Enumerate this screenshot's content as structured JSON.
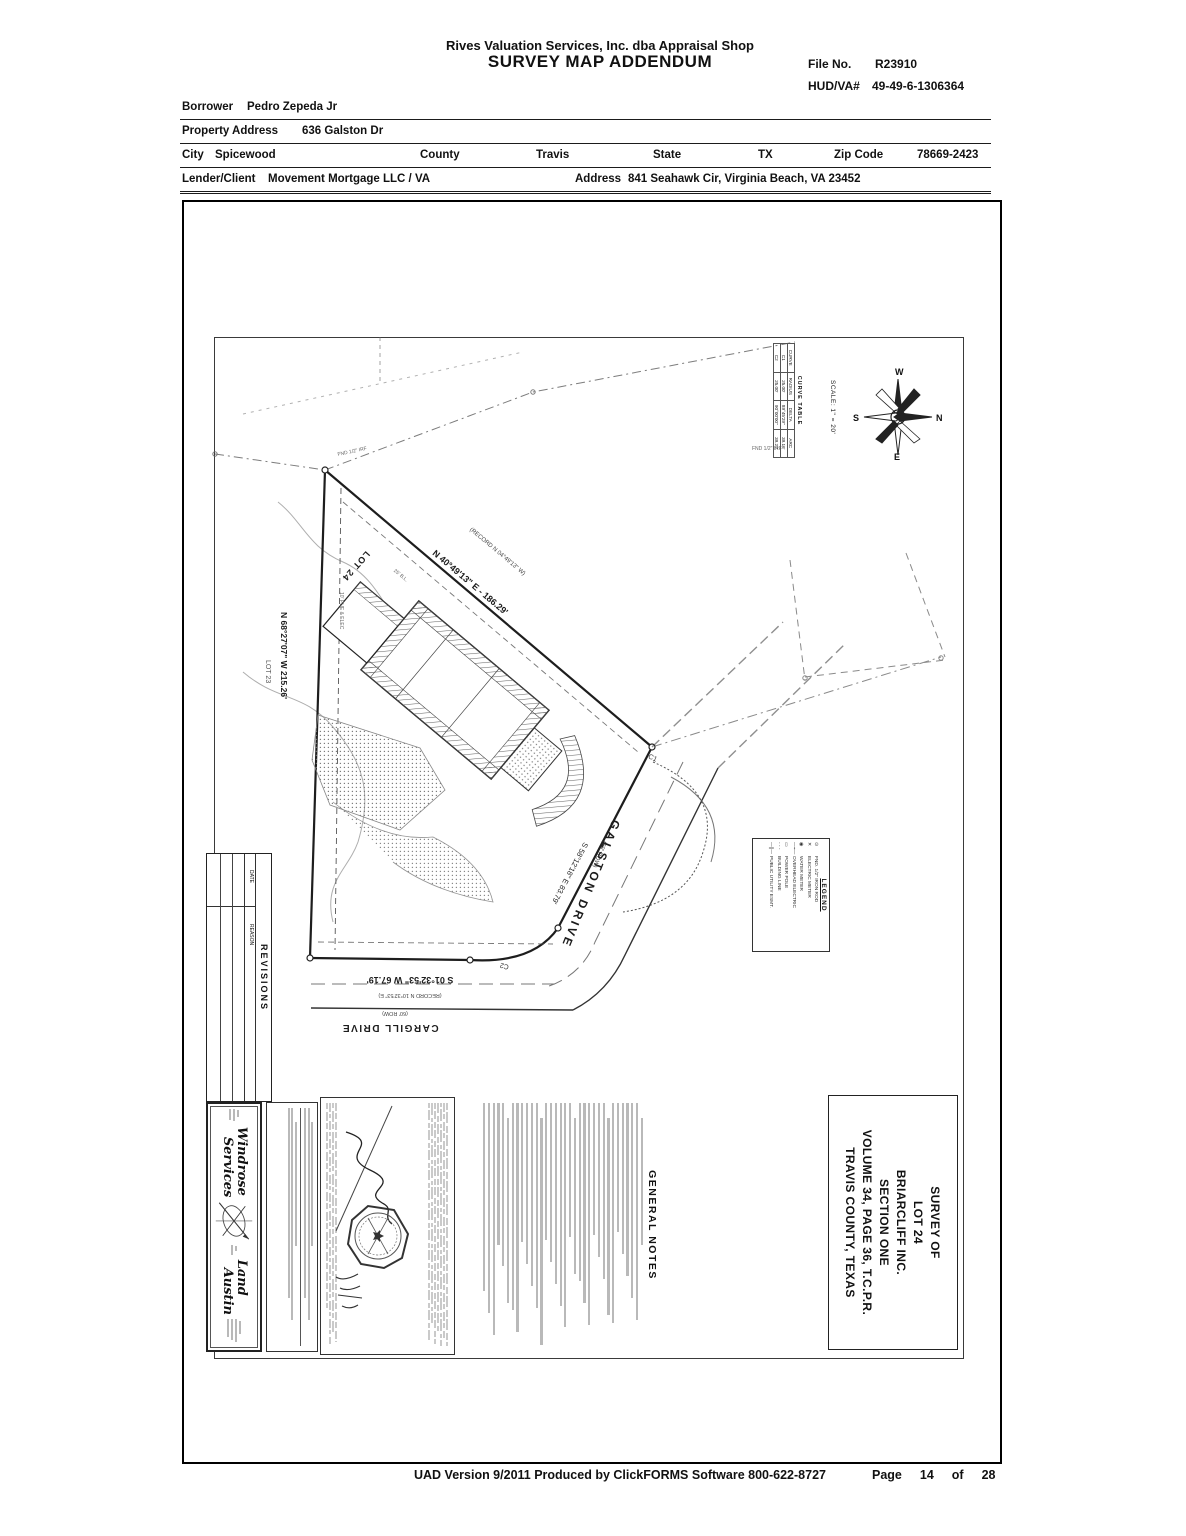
{
  "header": {
    "company": "Rives Valuation Services, Inc. dba Appraisal Shop",
    "title": "SURVEY MAP ADDENDUM",
    "file_no_label": "File No.",
    "file_no": "R23910",
    "hud_label": "HUD/VA#",
    "hud": "49-49-6-1306364"
  },
  "form": {
    "borrower_label": "Borrower",
    "borrower": "Pedro Zepeda Jr",
    "property_label": "Property Address",
    "property": "636 Galston Dr",
    "city_label": "City",
    "city": "Spicewood",
    "county_label": "County",
    "county": "Travis",
    "state_label": "State",
    "state": "TX",
    "zip_label": "Zip Code",
    "zip": "78669-2423",
    "lender_label": "Lender/Client",
    "lender": "Movement Mortgage LLC / VA",
    "address_label": "Address",
    "address": "841 Seahawk Cir, Virginia Beach, VA 23452"
  },
  "map": {
    "title_block": {
      "lines": [
        "SURVEY OF",
        "LOT 24",
        "BRIARCLIFF INC.",
        "SECTION ONE",
        "VOLUME 34, PAGE 36, T.C.P.R.",
        "TRAVIS COUNTY, TEXAS"
      ]
    },
    "notes_title": "GENERAL NOTES",
    "revisions": {
      "title": "REVISIONS",
      "date": "DATE",
      "reason": "REASON"
    },
    "compass": {
      "n": "N",
      "s": "S",
      "e": "E",
      "w": "W"
    },
    "scale": "SCALE: 1\" = 20'",
    "curve_table": {
      "title": "CURVE TABLE",
      "headers": [
        "CURVE",
        "RADIUS",
        "DELTA",
        "ARC"
      ],
      "rows": [
        [
          "C1",
          "25.00'",
          "89°45'29\"",
          "39.16'"
        ],
        [
          "C2",
          "25.00'",
          "90°00'00\"",
          "39.27'"
        ]
      ]
    },
    "legend": {
      "title": "LEGEND",
      "items": [
        {
          "sym": "⊙",
          "label": "FND. 1/2\" IRON ROD"
        },
        {
          "sym": "✕",
          "label": "ELECTRIC METER"
        },
        {
          "sym": "◉",
          "label": "WATER METER"
        },
        {
          "sym": "—⌁—",
          "label": "OVERHEAD ELECTRIC"
        },
        {
          "sym": "▭",
          "label": "POWER POLE"
        },
        {
          "sym": "- - -",
          "label": "BUILDING LINE"
        },
        {
          "sym": "—∥—",
          "label": "PUBLIC UTILITY ESMT."
        }
      ]
    },
    "streets": {
      "galston": "GALSTON DRIVE",
      "galston_row": "(60' ROW)",
      "cargill": "CARGILL DRIVE",
      "cargill_row": "(60' ROW)"
    },
    "bearings": {
      "ne": "N 40°49'13\" E - 186.29'",
      "ne_record": "(RECORD N 04°49'13\" W)",
      "west": "N 68°27'07\" W      215.26'",
      "galston": "S 58°12'18\" E   83.79'",
      "south": "S 01°32'53\" W    67.19'",
      "south_record": "(RECORD N 10°32'53\" E)"
    },
    "lots": {
      "lot24": "LOT 24",
      "lot23": "LOT 23"
    },
    "curves": {
      "c1": "C1",
      "c2": "C2"
    },
    "small_labels": {
      "fnd1": "FND 1/2\" IRF",
      "fnd2": "FND 1/2\" IRF",
      "pue": "10' PUE & ELEC",
      "bl": "25' B.L."
    },
    "surveyor": {
      "name1": "Windrose",
      "name2": "Services",
      "name3": "Land",
      "name4": "Austin"
    }
  },
  "footer": {
    "uad_line": "UAD Version 9/2011 Produced by ClickFORMS Software 800-622-8727",
    "page_label": "Page",
    "page_num": "14",
    "of_label": "of",
    "page_total": "28"
  }
}
